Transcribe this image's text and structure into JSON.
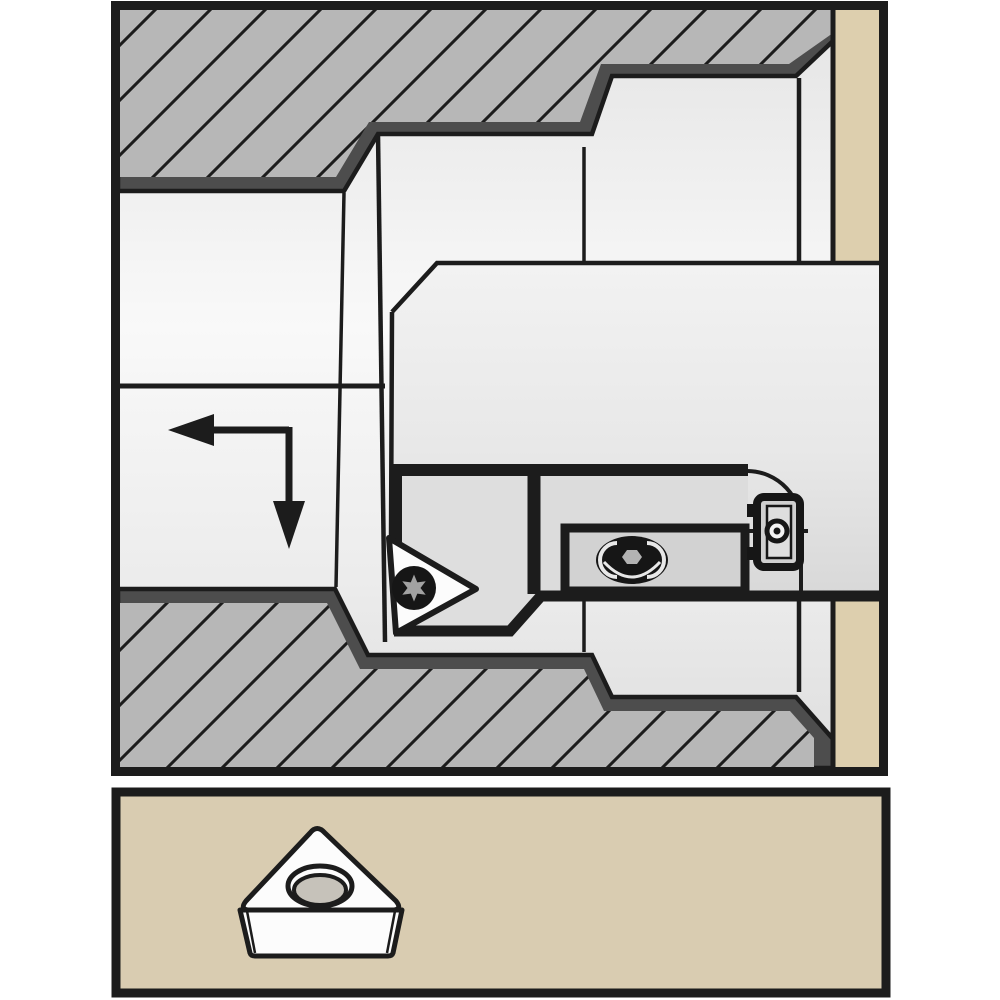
{
  "colors": {
    "frame": "#1c1c1c",
    "edge_dark_strip": "#4d4d4d",
    "hatch_fill": "#b7b7b7",
    "hatch_line": "#1c1c1c",
    "tan_strip": "#ddcfae",
    "panel_tan": "#d9ccb1",
    "cartridge": "#dedede",
    "clamp": "#dcdcdc",
    "recess": "#d2d2d2",
    "insert_white": "#fcfcfc",
    "hole_gray": "#c6c2ba",
    "screw_black": "#161616",
    "torx_gray": "#a2a2a2",
    "highlight": "#e8e8e8"
  },
  "top_panel": {
    "shapes": [
      {
        "n": "bore-background",
        "t": "rect",
        "x": 118,
        "y": 8,
        "wd": 762,
        "h": 760,
        "f": "url(#boreGrad)"
      },
      {
        "n": "workpiece-end-strip",
        "t": "rect",
        "x": 833,
        "y": 8,
        "wd": 47,
        "h": 760,
        "f": "tan_strip"
      },
      {
        "n": "workpiece-upper-edge",
        "t": "path",
        "d": "M118,8 L833,8 L833,41 L796,76 L612,76 L592,134 L378,134 L344,191 L118,191 Z",
        "f": "edge_dark_strip",
        "s": "frame",
        "w": 4.5
      },
      {
        "n": "workpiece-upper-hatch",
        "t": "path",
        "d": "M118,8 L833,8 L833,33 L789,64 L601,64 L580,122 L369,122 L336,177 L118,177 Z",
        "f": "url(#hatch)"
      },
      {
        "n": "workpiece-lower-edge",
        "t": "path",
        "d": "M118,768 L118,589 L335,589 L368,655 L592,655 L612,697 L796,697 L833,739 L833,768 Z",
        "f": "edge_dark_strip",
        "s": "frame",
        "w": 4.5
      },
      {
        "n": "workpiece-lower-hatch",
        "t": "path",
        "d": "M118,768 L118,603 L327,603 L360,669 L584,669 L604,711 L790,711 L814,738 L814,768 Z",
        "f": "url(#hatch)"
      },
      {
        "n": "centerline",
        "t": "path",
        "d": "M118,386 L385,386 M427,386 L455,386 M498,386 L772,386 M813,386 L843,386",
        "s": "frame",
        "w": 5
      },
      {
        "n": "bore-step-front-edge",
        "t": "path",
        "d": "M378,134 L385,642",
        "s": "frame",
        "w": 4.5
      },
      {
        "n": "bore-step-back-edge",
        "t": "path",
        "d": "M344,193 L336,587",
        "s": "frame",
        "w": 3.5
      },
      {
        "n": "bore-mid-step-edge",
        "t": "path",
        "d": "M584,147 L584,261 M584,598 L584,652",
        "s": "frame",
        "w": 3.5
      },
      {
        "n": "bore-opening-edge",
        "t": "path",
        "d": "M799,78 L799,261 M799,597 L799,692",
        "s": "frame",
        "w": 4.5
      },
      {
        "n": "end-strip-edge",
        "t": "path",
        "d": "M833,8 L833,261 M833,597 L833,768",
        "s": "frame",
        "w": 5
      },
      {
        "n": "boring-bar-shank",
        "t": "path",
        "d": "M392,312 L437,263 L880,263 L880,597 L541,597 L511,633 L396,633 L390,538 Z",
        "f": "url(#shankGrad)"
      },
      {
        "n": "shank-outline",
        "t": "path",
        "d": "M392,312 L437,263 L880,263 M392,312 L391,542",
        "s": "frame",
        "w": 4.5
      },
      {
        "n": "cartridge-block",
        "t": "path",
        "d": "M397,470 L534,470 L534,597 L541,597 L511,632 L397,632 Z",
        "f": "cartridge"
      },
      {
        "n": "clamp-block",
        "t": "rect",
        "x": 534,
        "y": 470,
        "wd": 214,
        "h": 127,
        "f": "clamp"
      },
      {
        "n": "clamp-recess",
        "t": "rect",
        "x": 565,
        "y": 528,
        "wd": 180,
        "h": 63,
        "f": "recess",
        "s": "frame",
        "w": 9
      },
      {
        "n": "head-top-edge",
        "t": "path",
        "d": "M392,470 L748,470",
        "s": "frame",
        "w": 12
      },
      {
        "n": "head-front-edge",
        "t": "path",
        "d": "M397,470 L397,542",
        "s": "frame",
        "w": 10
      },
      {
        "n": "head-division",
        "t": "path",
        "d": "M534,470 L534,594",
        "s": "frame",
        "w": 13
      },
      {
        "n": "head-bottom-edge",
        "t": "path",
        "d": "M394,631 L510,631 L541,596 L880,596",
        "s": "frame",
        "w": 11
      },
      {
        "n": "pocket-corner-arc",
        "t": "path",
        "d": "M748,471 A54,54 0 0 1 801,528 M801,528 L801,591",
        "s": "frame",
        "w": 4
      },
      {
        "n": "clamp-screw",
        "t": "ellipse",
        "cx": 632,
        "cy": 560,
        "rx": 36,
        "ry": 24,
        "f": "screw_black"
      },
      {
        "n": "clamp-screw-arc-left",
        "t": "path",
        "d": "M617,543 A16,16 0 0 0 617,577",
        "s": "highlight",
        "w": 4
      },
      {
        "n": "clamp-screw-arc-right",
        "t": "path",
        "d": "M647,543 A16,16 0 0 1 647,577",
        "s": "highlight",
        "w": 4
      },
      {
        "n": "clamp-screw-arc-bottom",
        "t": "path",
        "d": "M604,562 Q632,592 660,562",
        "s": "highlight",
        "w": 3
      },
      {
        "n": "clamp-screw-socket",
        "t": "polygon",
        "pts": "622,557 627,550 637,550 642,557 637,564 627,564",
        "f": "#b3b3b3"
      },
      {
        "n": "insert-in-holder",
        "t": "path",
        "d": "M389,538 L476,589 L396,633 Z",
        "f": "insert_white",
        "s": "frame",
        "w": 6,
        "lj": "round"
      },
      {
        "n": "insert-screw",
        "t": "circle",
        "cx": 414,
        "cy": 588,
        "r": 22,
        "f": "screw_black"
      },
      {
        "n": "insert-screw-torx-socket",
        "t": "polygon",
        "pts": "414,574.5 417.3,582.4 425.7,581.3 420.5,588 425.7,594.8 417.3,593.6 414,601.5 410.8,593.6 402.3,594.8 407.5,588 402.3,581.3 410.8,582.4",
        "f": "torx_gray"
      },
      {
        "n": "cartridge-screw-axis",
        "t": "path",
        "d": "M744,531 L808,531",
        "s": "frame",
        "w": 4
      },
      {
        "n": "cartridge-screw-frame",
        "t": "rect",
        "x": 757,
        "y": 497,
        "wd": 43,
        "h": 70,
        "rx": 7,
        "f": "#cfcfcf",
        "s": "screw_black",
        "w": 8
      },
      {
        "n": "cartridge-screw-inner",
        "t": "rect",
        "x": 767,
        "y": 506,
        "wd": 24,
        "h": 52,
        "f": "#dedede",
        "s": "screw_black",
        "w": 2.5
      },
      {
        "n": "cartridge-screw-tab-top",
        "t": "rect",
        "x": 747,
        "y": 504,
        "wd": 10,
        "h": 13,
        "f": "screw_black"
      },
      {
        "n": "cartridge-screw-tab-bottom",
        "t": "rect",
        "x": 747,
        "y": 547,
        "wd": 10,
        "h": 13,
        "f": "screw_black"
      },
      {
        "n": "cartridge-screw-head",
        "t": "circle",
        "cx": 777,
        "cy": 531,
        "r": 10,
        "f": "#f2f2f2",
        "s": "screw_black",
        "w": 5
      },
      {
        "n": "cartridge-screw-dot",
        "t": "circle",
        "cx": 777,
        "cy": 531,
        "r": 3.5,
        "f": "screw_black"
      },
      {
        "n": "feed-arrow-horizontal",
        "t": "path",
        "d": "M289,430 L212,430",
        "s": "frame",
        "w": 7
      },
      {
        "n": "feed-arrow-head-left",
        "t": "polygon",
        "pts": "168,430 214,414 214,446",
        "f": "frame"
      },
      {
        "n": "feed-arrow-vertical",
        "t": "path",
        "d": "M289,427 L289,503",
        "s": "frame",
        "w": 7
      },
      {
        "n": "feed-arrow-head-down",
        "t": "polygon",
        "pts": "289,549 273,501 305,501",
        "f": "frame"
      },
      {
        "n": "drawing-border",
        "t": "rect",
        "x": 115.5,
        "y": 5.5,
        "wd": 768,
        "h": 766,
        "s": "frame",
        "w": 9
      }
    ]
  },
  "bottom_panel": {
    "shapes": [
      {
        "n": "insert-panel-frame",
        "t": "rect",
        "x": 116,
        "y": 792,
        "wd": 770,
        "h": 201,
        "f": "panel_tan",
        "s": "frame",
        "w": 9
      },
      {
        "n": "insert-side-face",
        "t": "path",
        "d": "M240,910 L402,910 L393,953 Q392,956 388,956 L255,956 Q251,956 250,953 Z",
        "f": "insert_white",
        "s": "frame",
        "w": 5,
        "lj": "round"
      },
      {
        "n": "insert-side-facet-left",
        "t": "path",
        "d": "M247,911 L255,953",
        "s": "frame",
        "w": 2.5
      },
      {
        "n": "insert-side-facet-right",
        "t": "path",
        "d": "M395,911 L387,953",
        "s": "frame",
        "w": 2.5
      },
      {
        "n": "insert-top-face",
        "t": "path",
        "d": "M310,833 Q317,824 325,833 L396,901 Q403,910 392,910 L250,910 Q239,910 246,901 Z",
        "f": "insert_white",
        "s": "frame",
        "w": 5,
        "lj": "round"
      },
      {
        "n": "insert-hole-rim",
        "t": "ellipse",
        "cx": 320,
        "cy": 886,
        "rx": 32,
        "ry": 20,
        "f": "insert_white",
        "s": "frame",
        "w": 5
      },
      {
        "n": "insert-hole-bore",
        "t": "ellipse",
        "cx": 320,
        "cy": 890,
        "rx": 26,
        "ry": 15,
        "f": "hole_gray",
        "s": "frame",
        "w": 4
      }
    ]
  }
}
